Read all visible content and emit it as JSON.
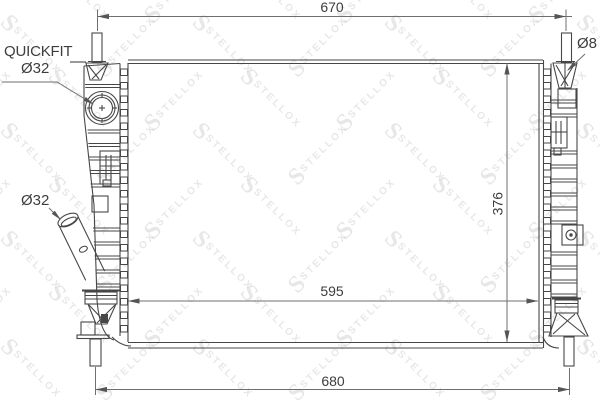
{
  "labels": {
    "quickfit": "QUICKFIT",
    "quickfit_diameter": "Ø32",
    "outlet_diameter": "Ø32",
    "pin_diameter": "Ø8"
  },
  "dimensions": {
    "overall_top_width": "670",
    "core_width": "595",
    "overall_bottom_width": "680",
    "core_height": "376"
  },
  "watermark": {
    "initial": "S",
    "brand": "STELLOX"
  },
  "colors": {
    "line": "#474747",
    "dimension_line": "#6f6f6f",
    "text": "#3d3d3d",
    "watermark": "rgba(70,70,70,0.13)",
    "background": "#ffffff"
  }
}
